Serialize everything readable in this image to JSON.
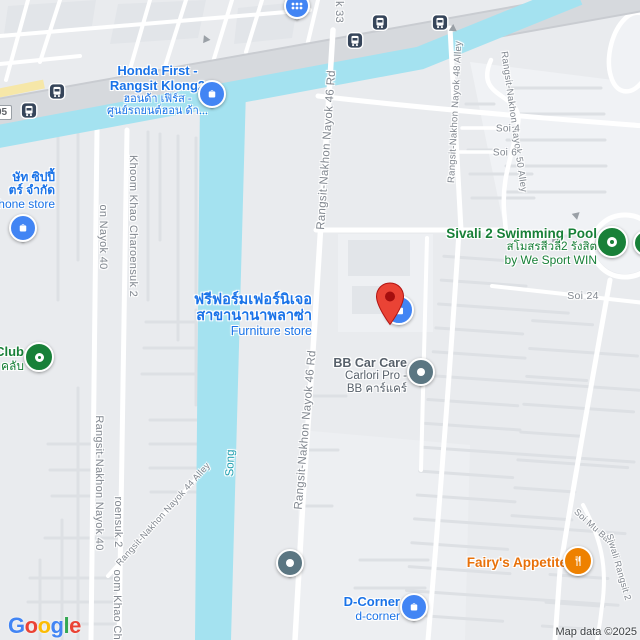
{
  "attribution": "Map data ©2025",
  "logo_letters": [
    "G",
    "o",
    "o",
    "g",
    "l",
    "e"
  ],
  "route_shield": "05",
  "colors": {
    "water": "#a4e2f0",
    "highway": "#d6d9dd",
    "poi_blue": "#1a73e8",
    "poi_green": "#188038",
    "poi_orange": "#e8710a",
    "poi_gray": "#57606a",
    "pin_blue": "#4285f4",
    "pin_red": "#ea4335",
    "pin_green": "#188038",
    "pin_slate": "#5b7682",
    "pin_orange": "#ee8100",
    "road_label": "#81878f",
    "water_label": "#1f9faf"
  },
  "pois": {
    "honda": {
      "line1": "Honda First -",
      "line2": "Rangsit Klong2",
      "line3": "ฮอนด้า เฟิร์ส -",
      "line4": "ศูนย์รถยนต์ฮอน ด้า...",
      "icon": "shopping-bag"
    },
    "phone": {
      "line1": "ษัท ซิปปี้",
      "line2": "ตร์ จำกัด",
      "line3": "hone store",
      "icon": "shopping-bag"
    },
    "furniture": {
      "line1": "ฟรีฟอร์มเฟอร์นิเจอ",
      "line2": "สาขานานาพลาซ่า",
      "line3": "Furniture store",
      "icon": "shopping-bag"
    },
    "club": {
      "line1": "Club",
      "line2": "คลับ",
      "icon": "ring"
    },
    "pool": {
      "line1": "Sivali 2 Swimming Pool",
      "line2": "สโมสรสีวลี2 รังสิต",
      "line3": "by We Sport WIN",
      "icon": "ring"
    },
    "bb": {
      "line1": "BB Car Care",
      "line2": "Carlori Pro -",
      "line3": "BB คาร์แคร์",
      "icon": "dot"
    },
    "dcorner": {
      "line1": "D-Corner",
      "line2": "d-corner",
      "icon": "shopping-bag"
    },
    "fairys": {
      "line1": "Fairy's Appetite",
      "icon": "restaurant"
    }
  },
  "road_labels": {
    "r33_fragment": "k 33",
    "r46_top": "Rangsit-Nakhon Nayok 46 Rd",
    "r46_bottom": "Rangsit-Nakhon Nayok 46 Rd",
    "r48_alley": "Rangsit-Nakhon Nayok 48 Alley",
    "r50_alley": "Rangsit-Nakhon Nayok 50 Alley",
    "r44_alley": "Rangsit-Nakhon Nayok 44 Alley",
    "r40_top_fragment": "on Nayok 40",
    "r40_bottom": "Rangsit-Nakhon Nayok 40",
    "khoom_top": "Khoom Khao Charoensuk 2",
    "khoom_mid_fragment": "roensuk 2",
    "khoom_bottom_fragment": "oom Khao Cha",
    "soi4": "Soi 4",
    "soi6": "Soi 6",
    "soi24": "Soi 24",
    "soi_mu_ban_1": "Soi Mu Ban",
    "soi_mu_ban_2": "Siwali Rangsit 2"
  },
  "water": {
    "song": "Song"
  }
}
